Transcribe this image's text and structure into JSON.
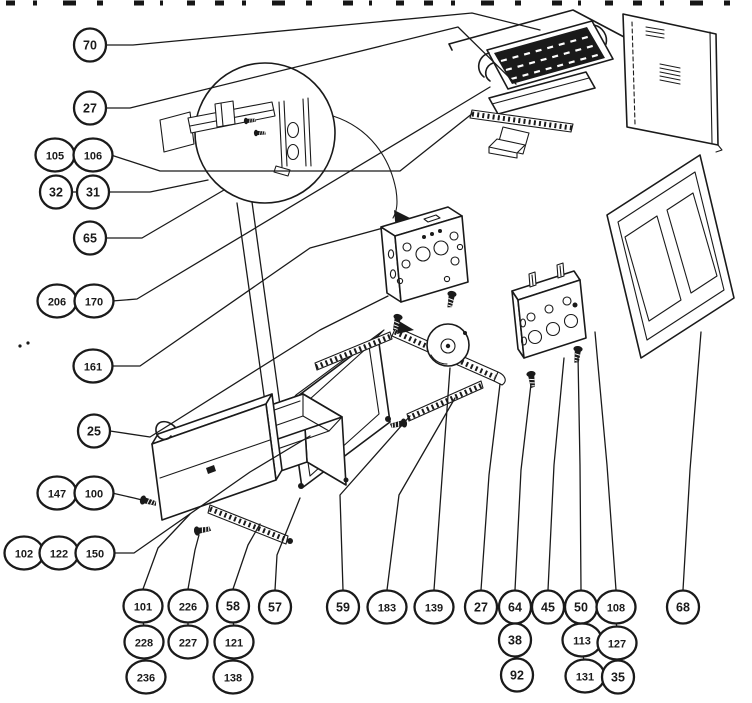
{
  "diagram": {
    "type": "exploded-parts-diagram",
    "paper_color": "#ffffff",
    "ink_color": "#1a1a1a",
    "callout_chains": [
      {
        "items": [
          {
            "label": "70",
            "x": 90,
            "y": 45
          }
        ],
        "leader": [
          [
            107,
            45
          ],
          [
            133,
            45
          ],
          [
            472,
            13
          ],
          [
            540,
            30
          ]
        ]
      },
      {
        "items": [
          {
            "label": "27",
            "x": 90,
            "y": 108
          }
        ],
        "leader": [
          [
            107,
            108
          ],
          [
            130,
            108
          ],
          [
            458,
            27
          ],
          [
            516,
            84
          ]
        ]
      },
      {
        "items": [
          {
            "label": "105",
            "x": 55,
            "y": 155
          },
          {
            "label": "106",
            "x": 93,
            "y": 155
          }
        ],
        "leader": [
          [
            111,
            155
          ],
          [
            160,
            171
          ],
          [
            400,
            171
          ],
          [
            473,
            113
          ]
        ]
      },
      {
        "items": [
          {
            "label": "32",
            "x": 56,
            "y": 192
          },
          {
            "label": "31",
            "x": 93,
            "y": 192
          }
        ],
        "leader": [
          [
            110,
            192
          ],
          [
            150,
            192
          ],
          [
            208,
            180
          ]
        ]
      },
      {
        "items": [
          {
            "label": "65",
            "x": 90,
            "y": 238
          }
        ],
        "leader": [
          [
            107,
            238
          ],
          [
            142,
            238
          ],
          [
            224,
            190
          ]
        ]
      },
      {
        "items": [
          {
            "label": "206",
            "x": 57,
            "y": 301
          },
          {
            "label": "170",
            "x": 94,
            "y": 301
          }
        ],
        "leader": [
          [
            112,
            301
          ],
          [
            137,
            299
          ],
          [
            432,
            122
          ],
          [
            490,
            87
          ]
        ]
      },
      {
        "items": [
          {
            "label": "161",
            "x": 93,
            "y": 366
          }
        ],
        "leader": [
          [
            110,
            366
          ],
          [
            140,
            366
          ],
          [
            310,
            248
          ],
          [
            383,
            228
          ]
        ]
      },
      {
        "items": [
          {
            "label": "25",
            "x": 94,
            "y": 431
          }
        ],
        "leader": [
          [
            110,
            431
          ],
          [
            150,
            437
          ],
          [
            320,
            330
          ],
          [
            388,
            296
          ]
        ]
      },
      {
        "items": [
          {
            "label": "147",
            "x": 57,
            "y": 493
          },
          {
            "label": "100",
            "x": 94,
            "y": 493
          }
        ],
        "leader": [
          [
            112,
            493
          ],
          [
            134,
            498
          ],
          [
            146,
            501
          ]
        ]
      },
      {
        "items": [
          {
            "label": "102",
            "x": 24,
            "y": 553
          },
          {
            "label": "122",
            "x": 59,
            "y": 553
          },
          {
            "label": "150",
            "x": 95,
            "y": 553
          }
        ],
        "leader": [
          [
            113,
            553
          ],
          [
            134,
            553
          ],
          [
            250,
            472
          ],
          [
            310,
            436
          ]
        ]
      },
      {
        "items": [
          {
            "label": "101",
            "x": 143,
            "y": 606
          },
          {
            "label": "228",
            "x": 144,
            "y": 642
          },
          {
            "label": "236",
            "x": 146,
            "y": 677
          }
        ],
        "leader": [
          [
            143,
            589
          ],
          [
            158,
            548
          ],
          [
            190,
            514
          ]
        ]
      },
      {
        "items": [
          {
            "label": "226",
            "x": 188,
            "y": 606
          },
          {
            "label": "227",
            "x": 188,
            "y": 642
          }
        ],
        "leader": [
          [
            188,
            589
          ],
          [
            195,
            550
          ],
          [
            199,
            535
          ]
        ]
      },
      {
        "items": [
          {
            "label": "58",
            "x": 233,
            "y": 606
          },
          {
            "label": "121",
            "x": 234,
            "y": 642
          },
          {
            "label": "138",
            "x": 233,
            "y": 677
          }
        ],
        "leader": [
          [
            233,
            589
          ],
          [
            248,
            545
          ],
          [
            260,
            524
          ]
        ]
      },
      {
        "items": [
          {
            "label": "57",
            "x": 275,
            "y": 607
          }
        ],
        "leader": [
          [
            275,
            590
          ],
          [
            277,
            555
          ],
          [
            300,
            498
          ]
        ]
      },
      {
        "items": [
          {
            "label": "59",
            "x": 343,
            "y": 607
          }
        ],
        "leader": [
          [
            343,
            590
          ],
          [
            340,
            495
          ],
          [
            410,
            416
          ]
        ]
      },
      {
        "items": [
          {
            "label": "183",
            "x": 387,
            "y": 607
          }
        ],
        "leader": [
          [
            387,
            590
          ],
          [
            399,
            495
          ],
          [
            455,
            398
          ]
        ]
      },
      {
        "items": [
          {
            "label": "139",
            "x": 434,
            "y": 607
          }
        ],
        "leader": [
          [
            434,
            590
          ],
          [
            442,
            478
          ],
          [
            450,
            368
          ]
        ]
      },
      {
        "items": [
          {
            "label": "27",
            "x": 481,
            "y": 607
          }
        ],
        "leader": [
          [
            481,
            590
          ],
          [
            489,
            475
          ],
          [
            500,
            384
          ]
        ]
      },
      {
        "items": [
          {
            "label": "64",
            "x": 515,
            "y": 607
          },
          {
            "label": "38",
            "x": 515,
            "y": 640
          },
          {
            "label": "92",
            "x": 517,
            "y": 675
          }
        ],
        "leader": [
          [
            515,
            590
          ],
          [
            521,
            470
          ],
          [
            531,
            384
          ]
        ]
      },
      {
        "items": [
          {
            "label": "45",
            "x": 548,
            "y": 607
          }
        ],
        "leader": [
          [
            548,
            590
          ],
          [
            554,
            465
          ],
          [
            564,
            358
          ]
        ]
      },
      {
        "items": [
          {
            "label": "50",
            "x": 581,
            "y": 607
          },
          {
            "label": "113",
            "x": 582,
            "y": 640
          },
          {
            "label": "131",
            "x": 585,
            "y": 676
          }
        ],
        "leader": [
          [
            581,
            590
          ],
          [
            580,
            465
          ],
          [
            578,
            356
          ]
        ]
      },
      {
        "items": [
          {
            "label": "108",
            "x": 616,
            "y": 607
          },
          {
            "label": "127",
            "x": 617,
            "y": 643
          },
          {
            "label": "35",
            "x": 618,
            "y": 677
          }
        ],
        "leader": [
          [
            616,
            590
          ],
          [
            607,
            465
          ],
          [
            595,
            332
          ]
        ]
      },
      {
        "items": [
          {
            "label": "68",
            "x": 683,
            "y": 607
          }
        ],
        "leader": [
          [
            683,
            590
          ],
          [
            690,
            470
          ],
          [
            701,
            332
          ]
        ]
      }
    ]
  }
}
